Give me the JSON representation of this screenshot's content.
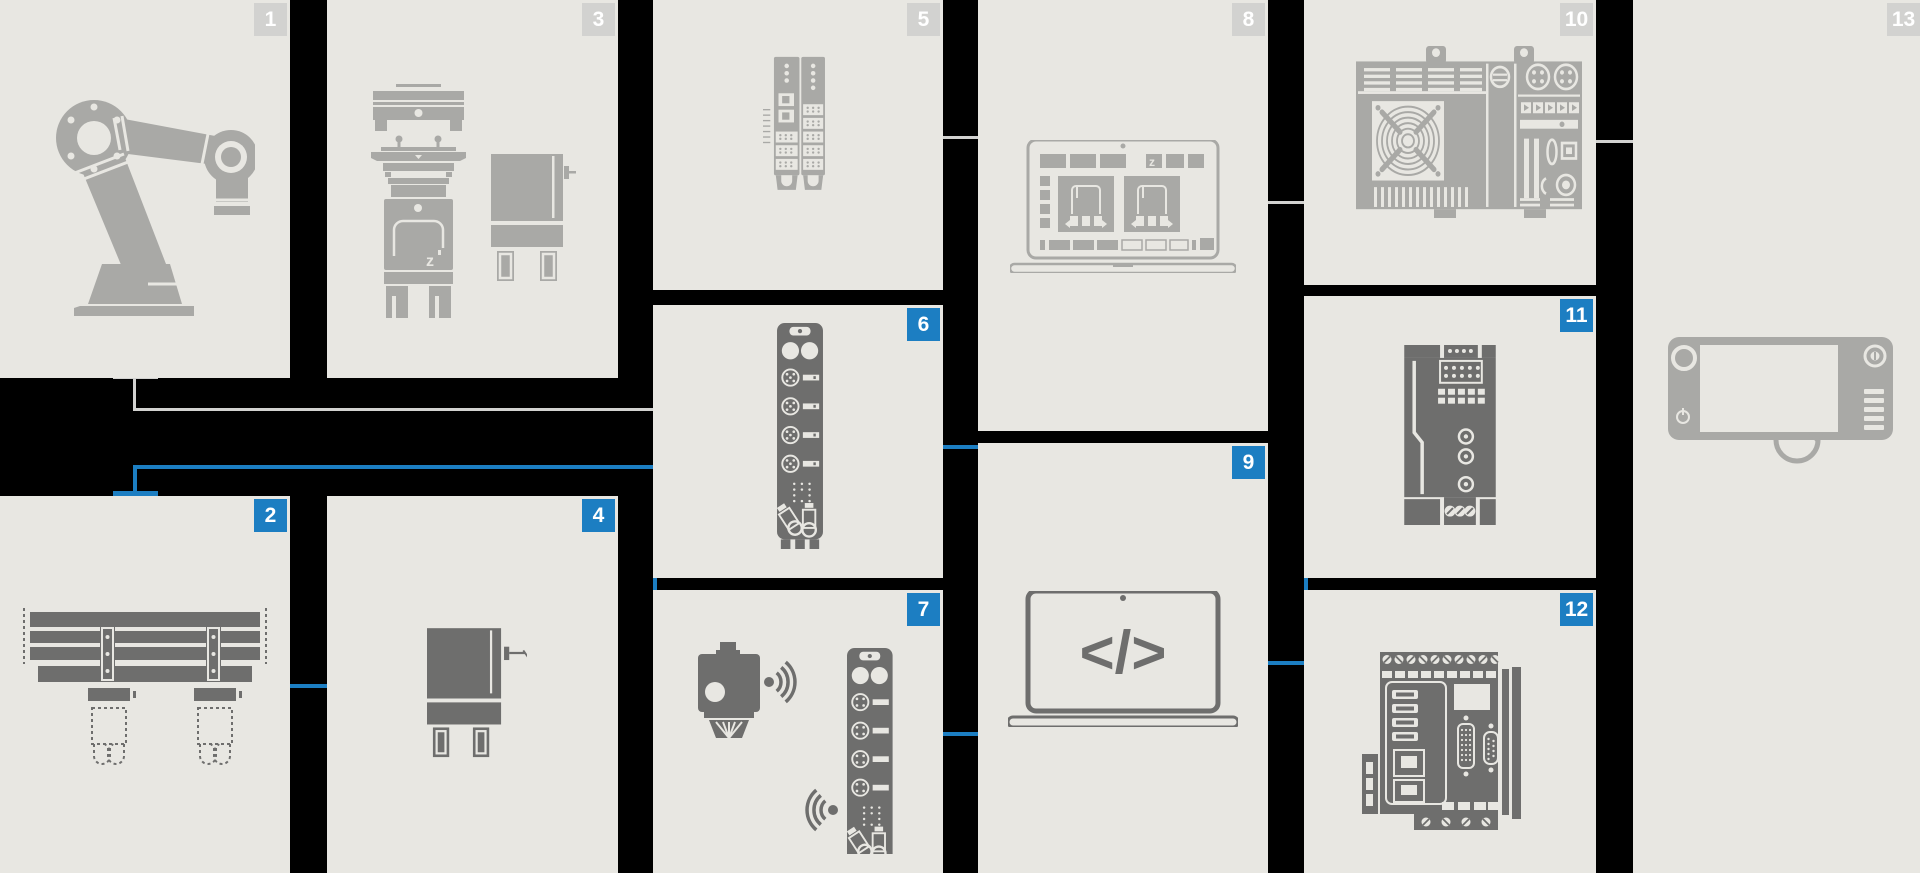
{
  "palette": {
    "background": "#000000",
    "card_background": "#e8e7e2",
    "badge_gray": "#d2d2d0",
    "badge_blue": "#1c7ec2",
    "badge_text": "#ffffff",
    "icon_light_gray": "#a9a9a6",
    "icon_dark_gray": "#6e6e6d",
    "connector_gray": "#d2d2d0",
    "connector_blue": "#1c7ec2"
  },
  "cards": [
    {
      "number": "1",
      "badge": "gray",
      "icon": "robot-arm"
    },
    {
      "number": "2",
      "badge": "blue",
      "icon": "gantry-linear-unit"
    },
    {
      "number": "3",
      "badge": "gray",
      "icon": "machines-pair"
    },
    {
      "number": "4",
      "badge": "blue",
      "icon": "machine-cabinet"
    },
    {
      "number": "5",
      "badge": "gray",
      "icon": "io-terminal-modules"
    },
    {
      "number": "6",
      "badge": "blue",
      "icon": "fieldbus-io-block"
    },
    {
      "number": "7",
      "badge": "blue",
      "icon": "wireless-sensor-and-io-block"
    },
    {
      "number": "8",
      "badge": "gray",
      "icon": "laptop-engineering-software"
    },
    {
      "number": "9",
      "badge": "blue",
      "icon": "laptop-code"
    },
    {
      "number": "10",
      "badge": "gray",
      "icon": "industrial-pc"
    },
    {
      "number": "11",
      "badge": "blue",
      "icon": "power-supply"
    },
    {
      "number": "12",
      "badge": "blue",
      "icon": "embedded-controller"
    },
    {
      "number": "13",
      "badge": "gray",
      "icon": "handheld-hmi-panel"
    }
  ],
  "connections": [
    {
      "from": "1",
      "to": "6",
      "color": "gray"
    },
    {
      "from": "5",
      "to": "8",
      "color": "gray"
    },
    {
      "from": "8",
      "to": "10",
      "color": "gray"
    },
    {
      "from": "10",
      "to": "13",
      "color": "gray"
    },
    {
      "from": "2",
      "to": "6",
      "color": "blue"
    },
    {
      "from": "2",
      "to": "4",
      "color": "blue"
    },
    {
      "from": "6",
      "to": "9",
      "color": "blue"
    },
    {
      "from": "7",
      "to": "9",
      "color": "blue"
    },
    {
      "from": "9",
      "to": "11",
      "color": "blue"
    },
    {
      "from": "9",
      "to": "12",
      "color": "blue"
    }
  ]
}
